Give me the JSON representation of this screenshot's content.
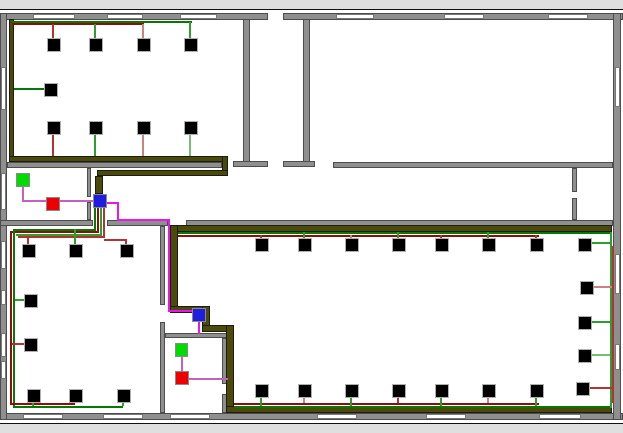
{
  "app": {
    "title": "Floor plan network cabling layout",
    "description": "Building floor plan with cabled network devices, conduits and hub nodes"
  },
  "canvas": {
    "width": 623,
    "height": 413,
    "background": "#ffffff",
    "frame_color": "#111111"
  },
  "palette": {
    "wall": "#8f8f8f",
    "wall_border": "#4d4d4d",
    "window": "#ffffff",
    "conduit": "#4b4b07",
    "green_dark": "#067806",
    "green_mid": "#2e9e2e",
    "green_light": "#76bd76",
    "red_dark": "#8e0d0d",
    "red_mid": "#b33333",
    "red_light": "#c98383",
    "magenta": "#c45fc4",
    "magenta_bright": "#e816e8",
    "device": "#000000",
    "node_green": "#00dc00",
    "node_red": "#ef0000",
    "node_blue": "#1e1ee0"
  },
  "walls": [
    [
      0,
      3,
      268,
      7
    ],
    [
      283,
      3,
      340,
      7
    ],
    [
      0,
      403,
      623,
      7
    ],
    [
      0,
      3,
      7,
      407
    ],
    [
      613,
      3,
      8,
      407
    ],
    [
      243,
      9,
      7,
      144
    ],
    [
      233,
      151,
      35,
      6
    ],
    [
      303,
      9,
      7,
      144
    ],
    [
      283,
      151,
      32,
      6
    ],
    [
      7,
      152,
      215,
      6
    ],
    [
      333,
      152,
      280,
      6
    ],
    [
      572,
      158,
      5,
      24
    ],
    [
      572,
      188,
      5,
      22
    ],
    [
      0,
      210,
      93,
      6
    ],
    [
      107,
      210,
      61,
      6
    ],
    [
      186,
      210,
      427,
      6
    ],
    [
      87,
      158,
      4,
      29
    ],
    [
      87,
      192,
      4,
      18
    ],
    [
      160,
      216,
      5,
      79
    ],
    [
      160,
      312,
      5,
      91
    ],
    [
      165,
      323,
      62,
      5
    ],
    [
      222,
      328,
      5,
      46
    ],
    [
      222,
      384,
      5,
      19
    ]
  ],
  "windows": [
    [
      33,
      4,
      42,
      5
    ],
    [
      107,
      4,
      36,
      5
    ],
    [
      180,
      4,
      37,
      5
    ],
    [
      336,
      4,
      38,
      5
    ],
    [
      444,
      4,
      40,
      5
    ],
    [
      548,
      4,
      40,
      5
    ],
    [
      23,
      404,
      40,
      5
    ],
    [
      103,
      404,
      40,
      5
    ],
    [
      170,
      404,
      40,
      5
    ],
    [
      317,
      404,
      40,
      5
    ],
    [
      426,
      404,
      40,
      5
    ],
    [
      539,
      404,
      42,
      5
    ],
    [
      1,
      57,
      5,
      43
    ],
    [
      1,
      163,
      5,
      37
    ],
    [
      1,
      231,
      5,
      28
    ],
    [
      1,
      280,
      5,
      15
    ],
    [
      1,
      323,
      5,
      24
    ],
    [
      1,
      351,
      5,
      18
    ],
    [
      615,
      57,
      5,
      40
    ],
    [
      615,
      244,
      5,
      40
    ],
    [
      615,
      334,
      5,
      26
    ]
  ],
  "conduits": [
    [
      9,
      9,
      5,
      140
    ],
    [
      9,
      146,
      219,
      6
    ],
    [
      222,
      146,
      6,
      20
    ],
    [
      97,
      160,
      131,
      6
    ],
    [
      95,
      166,
      8,
      18
    ],
    [
      170,
      215,
      442,
      7
    ],
    [
      170,
      215,
      8,
      85
    ],
    [
      170,
      296,
      40,
      7
    ],
    [
      202,
      296,
      8,
      26
    ],
    [
      202,
      315,
      32,
      7
    ],
    [
      226,
      315,
      8,
      83
    ],
    [
      226,
      396,
      386,
      7
    ]
  ],
  "wires": [
    {
      "r": [
        12,
        11,
        180,
        2
      ],
      "c": "green_dark"
    },
    {
      "r": [
        12,
        13,
        132,
        2
      ],
      "c": "red_dark"
    },
    {
      "r": [
        52,
        14,
        2,
        14
      ],
      "c": "red_mid"
    },
    {
      "r": [
        94,
        14,
        2,
        14
      ],
      "c": "green_mid"
    },
    {
      "r": [
        142,
        14,
        2,
        14
      ],
      "c": "red_light"
    },
    {
      "r": [
        189,
        12,
        2,
        16
      ],
      "c": "green_mid"
    },
    {
      "r": [
        14,
        78,
        30,
        2
      ],
      "c": "green_dark"
    },
    {
      "r": [
        52,
        124,
        2,
        22
      ],
      "c": "red_mid"
    },
    {
      "r": [
        94,
        124,
        2,
        22
      ],
      "c": "green_mid"
    },
    {
      "r": [
        142,
        124,
        2,
        22
      ],
      "c": "red_light"
    },
    {
      "r": [
        189,
        124,
        2,
        22
      ],
      "c": "green_light"
    },
    {
      "r": [
        94,
        198,
        2,
        23
      ],
      "c": "green_dark"
    },
    {
      "r": [
        97,
        198,
        2,
        25
      ],
      "c": "red_dark"
    },
    {
      "r": [
        100,
        198,
        2,
        28
      ],
      "c": "green_mid"
    },
    {
      "r": [
        103,
        198,
        2,
        30
      ],
      "c": "red_mid"
    },
    {
      "r": [
        14,
        219,
        82,
        2
      ],
      "c": "green_dark"
    },
    {
      "r": [
        11,
        221,
        88,
        2
      ],
      "c": "red_dark"
    },
    {
      "r": [
        16,
        224,
        86,
        2
      ],
      "c": "green_mid"
    },
    {
      "r": [
        18,
        226,
        87,
        2
      ],
      "c": "red_mid"
    },
    {
      "r": [
        13,
        219,
        2,
        178
      ],
      "c": "green_dark"
    },
    {
      "r": [
        10,
        221,
        2,
        174
      ],
      "c": "red_dark"
    },
    {
      "r": [
        13,
        396,
        110,
        2
      ],
      "c": "green_dark"
    },
    {
      "r": [
        10,
        393,
        65,
        2
      ],
      "c": "red_dark"
    },
    {
      "r": [
        27,
        226,
        2,
        8
      ],
      "c": "red_mid"
    },
    {
      "r": [
        74,
        219,
        2,
        15
      ],
      "c": "green_mid"
    },
    {
      "r": [
        104,
        229,
        22,
        2
      ],
      "c": "red_mid"
    },
    {
      "r": [
        125,
        229,
        2,
        5
      ],
      "c": "red_mid"
    },
    {
      "r": [
        15,
        289,
        9,
        2
      ],
      "c": "green_mid"
    },
    {
      "r": [
        12,
        333,
        12,
        2
      ],
      "c": "red_mid"
    },
    {
      "r": [
        32,
        392,
        2,
        4
      ],
      "c": "green_mid"
    },
    {
      "r": [
        122,
        392,
        2,
        4
      ],
      "c": "green_mid"
    },
    {
      "r": [
        22,
        177,
        2,
        15
      ],
      "c": "magenta"
    },
    {
      "r": [
        22,
        190,
        24,
        2
      ],
      "c": "magenta"
    },
    {
      "r": [
        60,
        190,
        33,
        2
      ],
      "c": "magenta"
    },
    {
      "r": [
        107,
        192,
        11,
        2
      ],
      "c": "magenta_bright"
    },
    {
      "r": [
        117,
        192,
        2,
        19
      ],
      "c": "magenta_bright"
    },
    {
      "r": [
        117,
        209,
        52,
        2
      ],
      "c": "magenta_bright"
    },
    {
      "r": [
        168,
        209,
        2,
        93
      ],
      "c": "magenta_bright"
    },
    {
      "r": [
        168,
        300,
        26,
        2
      ],
      "c": "magenta_bright"
    },
    {
      "r": [
        198,
        311,
        2,
        13
      ],
      "c": "magenta_bright"
    },
    {
      "r": [
        181,
        347,
        2,
        15
      ],
      "c": "magenta"
    },
    {
      "r": [
        189,
        368,
        39,
        2
      ],
      "c": "magenta"
    },
    {
      "r": [
        178,
        222,
        434,
        2
      ],
      "c": "green_dark"
    },
    {
      "r": [
        178,
        225,
        361,
        2
      ],
      "c": "red_dark"
    },
    {
      "r": [
        260,
        225,
        2,
        3
      ],
      "c": "red_mid"
    },
    {
      "r": [
        303,
        222,
        2,
        6
      ],
      "c": "green_mid"
    },
    {
      "r": [
        350,
        225,
        2,
        3
      ],
      "c": "red_light"
    },
    {
      "r": [
        397,
        222,
        2,
        6
      ],
      "c": "green_mid"
    },
    {
      "r": [
        440,
        225,
        2,
        3
      ],
      "c": "red_mid"
    },
    {
      "r": [
        487,
        222,
        2,
        6
      ],
      "c": "green_mid"
    },
    {
      "r": [
        535,
        225,
        2,
        3
      ],
      "c": "red_mid"
    },
    {
      "r": [
        591,
        232,
        20,
        2
      ],
      "c": "green_mid"
    },
    {
      "r": [
        610,
        222,
        2,
        176
      ],
      "c": "green_mid"
    },
    {
      "r": [
        612,
        236,
        2,
        157
      ],
      "c": "red_mid"
    },
    {
      "r": [
        593,
        276,
        19,
        2
      ],
      "c": "red_light"
    },
    {
      "r": [
        591,
        311,
        19,
        2
      ],
      "c": "green_mid"
    },
    {
      "r": [
        591,
        344,
        19,
        2
      ],
      "c": "green_light"
    },
    {
      "r": [
        589,
        377,
        23,
        2
      ],
      "c": "red_mid"
    },
    {
      "r": [
        234,
        393,
        305,
        2
      ],
      "c": "red_dark"
    },
    {
      "r": [
        234,
        396,
        376,
        2
      ],
      "c": "green_dark"
    },
    {
      "r": [
        260,
        387,
        2,
        9
      ],
      "c": "green_mid"
    },
    {
      "r": [
        350,
        387,
        2,
        9
      ],
      "c": "green_mid"
    },
    {
      "r": [
        440,
        387,
        2,
        9
      ],
      "c": "green_mid"
    },
    {
      "r": [
        535,
        387,
        2,
        9
      ],
      "c": "green_mid"
    },
    {
      "r": [
        303,
        387,
        2,
        6
      ],
      "c": "red_light"
    },
    {
      "r": [
        397,
        387,
        2,
        6
      ],
      "c": "red_mid"
    },
    {
      "r": [
        487,
        387,
        2,
        6
      ],
      "c": "red_light"
    }
  ],
  "devices": [
    [
      47,
      28
    ],
    [
      89,
      28
    ],
    [
      137,
      28
    ],
    [
      184,
      28
    ],
    [
      44,
      73
    ],
    [
      47,
      111
    ],
    [
      89,
      111
    ],
    [
      137,
      111
    ],
    [
      184,
      111
    ],
    [
      22,
      234
    ],
    [
      69,
      234
    ],
    [
      120,
      234
    ],
    [
      24,
      284
    ],
    [
      24,
      328
    ],
    [
      27,
      379
    ],
    [
      69,
      379
    ],
    [
      117,
      379
    ],
    [
      255,
      228
    ],
    [
      298,
      228
    ],
    [
      345,
      228
    ],
    [
      392,
      228
    ],
    [
      435,
      228
    ],
    [
      482,
      228
    ],
    [
      530,
      228
    ],
    [
      578,
      228
    ],
    [
      580,
      271
    ],
    [
      578,
      306
    ],
    [
      578,
      339
    ],
    [
      255,
      374
    ],
    [
      298,
      374
    ],
    [
      345,
      374
    ],
    [
      392,
      374
    ],
    [
      435,
      374
    ],
    [
      482,
      374
    ],
    [
      530,
      374
    ],
    [
      576,
      372
    ]
  ],
  "nodes": [
    {
      "t": "green",
      "r": [
        16,
        163,
        14,
        14
      ]
    },
    {
      "t": "red",
      "r": [
        46,
        187,
        14,
        14
      ]
    },
    {
      "t": "blue",
      "r": [
        93,
        184,
        14,
        14
      ]
    },
    {
      "t": "blue",
      "r": [
        192,
        298,
        14,
        14
      ]
    },
    {
      "t": "green",
      "r": [
        175,
        333,
        13,
        14
      ]
    },
    {
      "t": "red",
      "r": [
        175,
        361,
        14,
        14
      ]
    }
  ]
}
